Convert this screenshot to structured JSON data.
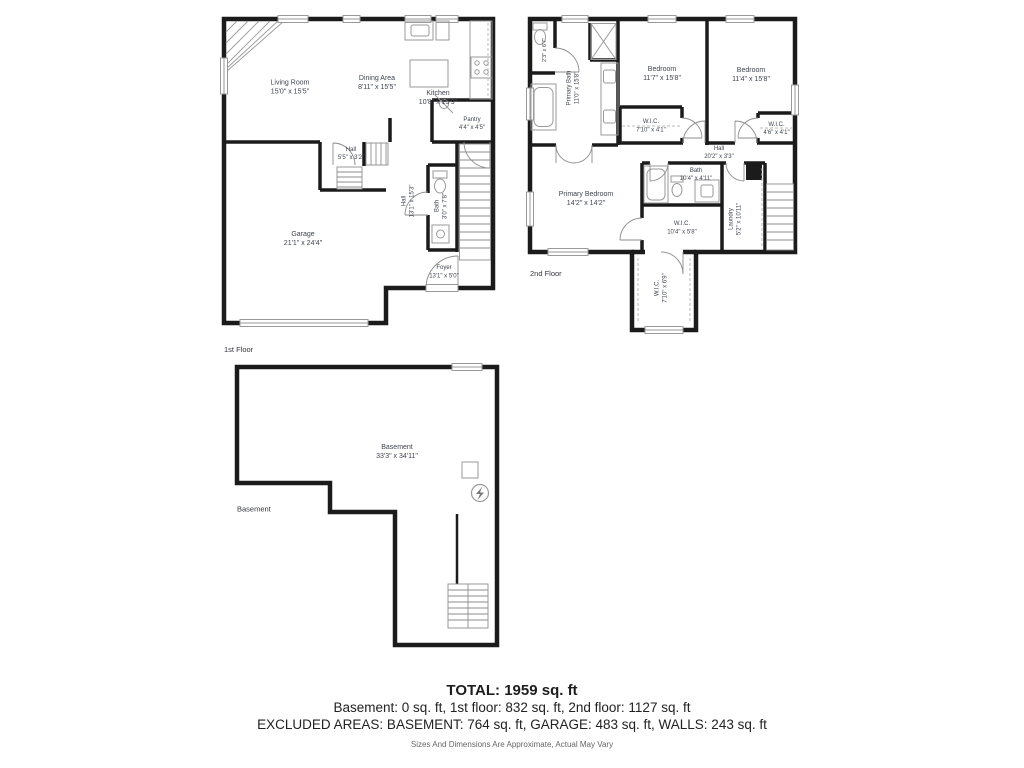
{
  "floors": {
    "first": {
      "label": "1st Floor",
      "rooms": {
        "living": {
          "name": "Living Room",
          "dims": "15'0\" x 15'5\""
        },
        "dining": {
          "name": "Dining Area",
          "dims": "8'11\" x 15'5\""
        },
        "kitchen": {
          "name": "Kitchen",
          "dims": "10'8\" x 15'9\""
        },
        "pantry": {
          "name": "Pantry",
          "dims": "4'4\" x 4'5\""
        },
        "hall_small": {
          "name": "Hall",
          "dims": "5'5\" x 3'2\""
        },
        "garage": {
          "name": "Garage",
          "dims": "21'1\" x 24'4\""
        },
        "hall": {
          "name": "Hall",
          "dims": "13'1\" x 15'3\""
        },
        "bath": {
          "name": "Bath",
          "dims": "3'0\" x 7'8\""
        },
        "foyer": {
          "name": "Foyer",
          "dims": "13'1\" x 5'0\""
        }
      }
    },
    "second": {
      "label": "2nd Floor",
      "rooms": {
        "wc": {
          "dims": "2'3\" x 6'7\""
        },
        "primary_bath": {
          "name": "Primary Bath",
          "dims": "11'0\" x 15'8\""
        },
        "bedroom1": {
          "name": "Bedroom",
          "dims": "11'7\" x 15'8\""
        },
        "bedroom2": {
          "name": "Bedroom",
          "dims": "11'4\" x 15'8\""
        },
        "wic1": {
          "name": "W.I.C.",
          "dims": "7'10\" x 4'1\""
        },
        "wic2": {
          "name": "W.I.C.",
          "dims": "4'6\" x 4'1\""
        },
        "hall": {
          "name": "Hall",
          "dims": "20'2\" x 3'3\""
        },
        "primary_bedroom": {
          "name": "Primary Bedroom",
          "dims": "14'2\" x 14'2\""
        },
        "bath": {
          "name": "Bath",
          "dims": "10'4\" x 4'11\""
        },
        "wic3": {
          "name": "W.I.C.",
          "dims": "10'4\" x 5'8\""
        },
        "laundry": {
          "name": "Laundry",
          "dims": "5'2\" x 10'11\""
        },
        "wic4": {
          "name": "W.I.C.",
          "dims": "7'10\" x 6'9\""
        }
      }
    },
    "basement": {
      "label": "Basement",
      "rooms": {
        "basement": {
          "name": "Basement",
          "dims": "33'3\" x 34'11\""
        }
      }
    }
  },
  "summary": {
    "total": "TOTAL: 1959 sq. ft",
    "floors_line": "Basement: 0 sq. ft, 1st floor: 832 sq. ft, 2nd floor: 1127 sq. ft",
    "excluded_line": "EXCLUDED AREAS: BASEMENT: 764 sq. ft, GARAGE: 483 sq. ft, WALLS: 243 sq. ft",
    "disclaimer": "Sizes And Dimensions Are Approximate, Actual May Vary"
  },
  "colors": {
    "wall": "#1b1b1b",
    "fixture": "#9a9a9a",
    "label_text": "#3f4450"
  }
}
